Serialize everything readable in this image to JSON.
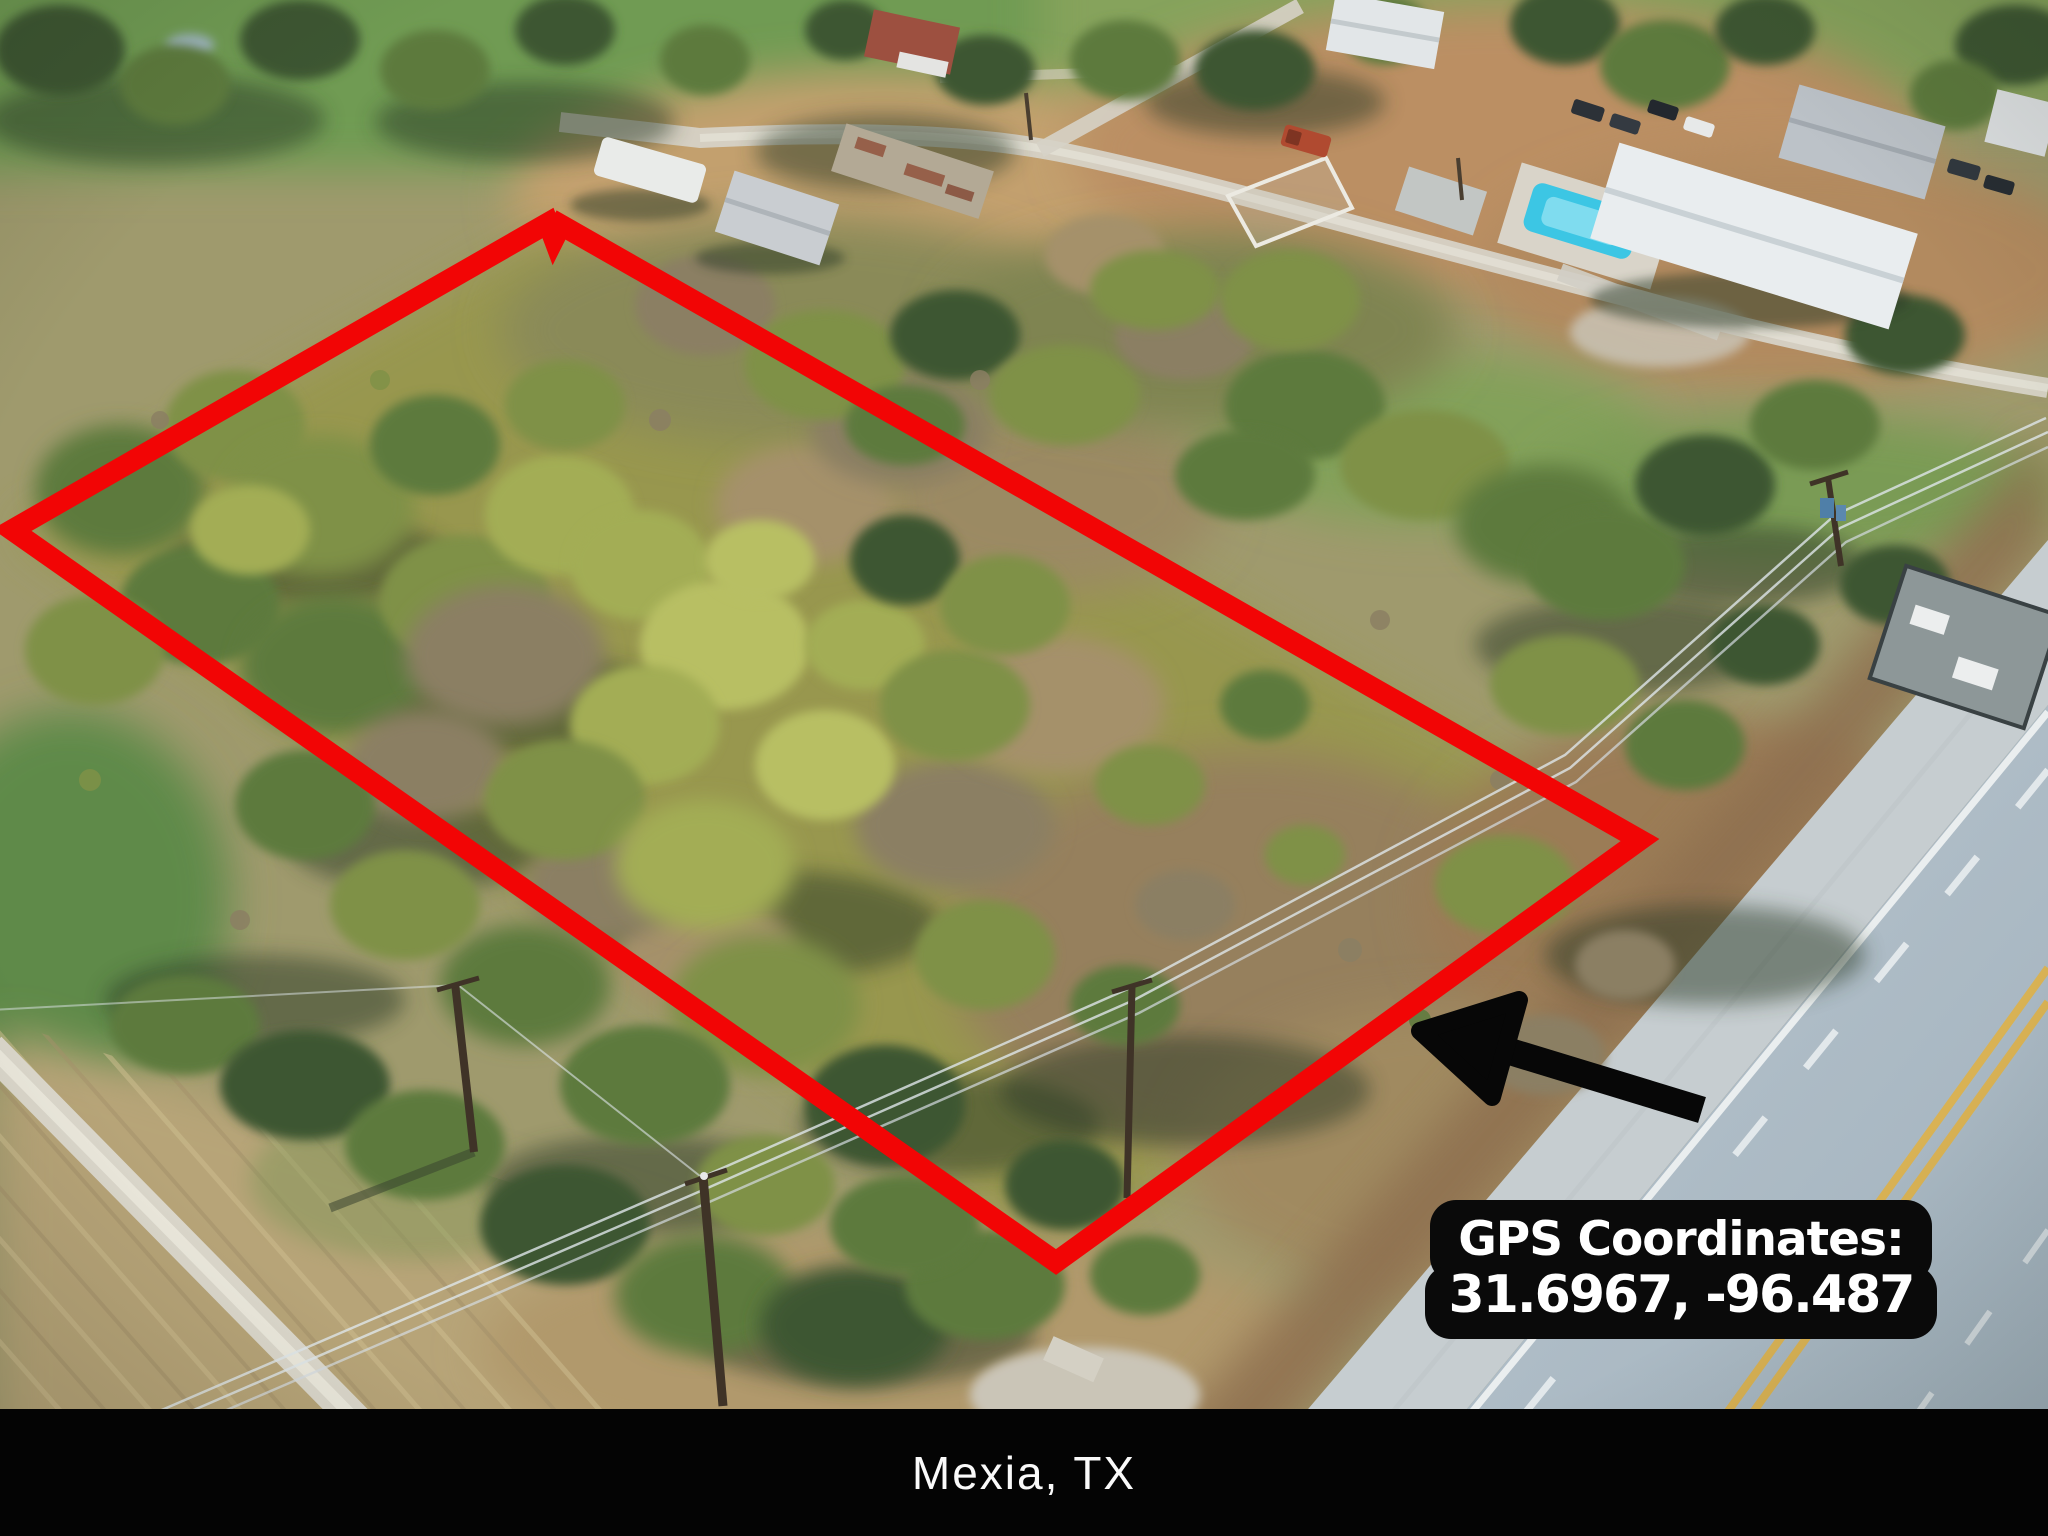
{
  "image": {
    "width": 2048,
    "height": 1536
  },
  "overlay": {
    "gps_label": {
      "title": "GPS Coordinates:",
      "coordinates": "31.6967, -96.487",
      "background": "#0a0a0a",
      "text_color": "#ffffff"
    },
    "location_bar": {
      "text": "Mexia, TX",
      "background": "#040404",
      "text_color": "#fafafa"
    },
    "property_boundary": {
      "color": "#f20505",
      "stroke_width": 21,
      "vertices": [
        [
          12,
          530
        ],
        [
          553,
          228
        ],
        [
          1640,
          840
        ],
        [
          1056,
          1262
        ]
      ]
    },
    "arrow": {
      "color": "#000000",
      "tip": [
        1420,
        1031
      ],
      "tail": [
        1702,
        1110
      ]
    }
  },
  "scene": {
    "type": "aerial-drone-photo",
    "subject": "wooded rural land parcel outlined in red beside a highway"
  }
}
